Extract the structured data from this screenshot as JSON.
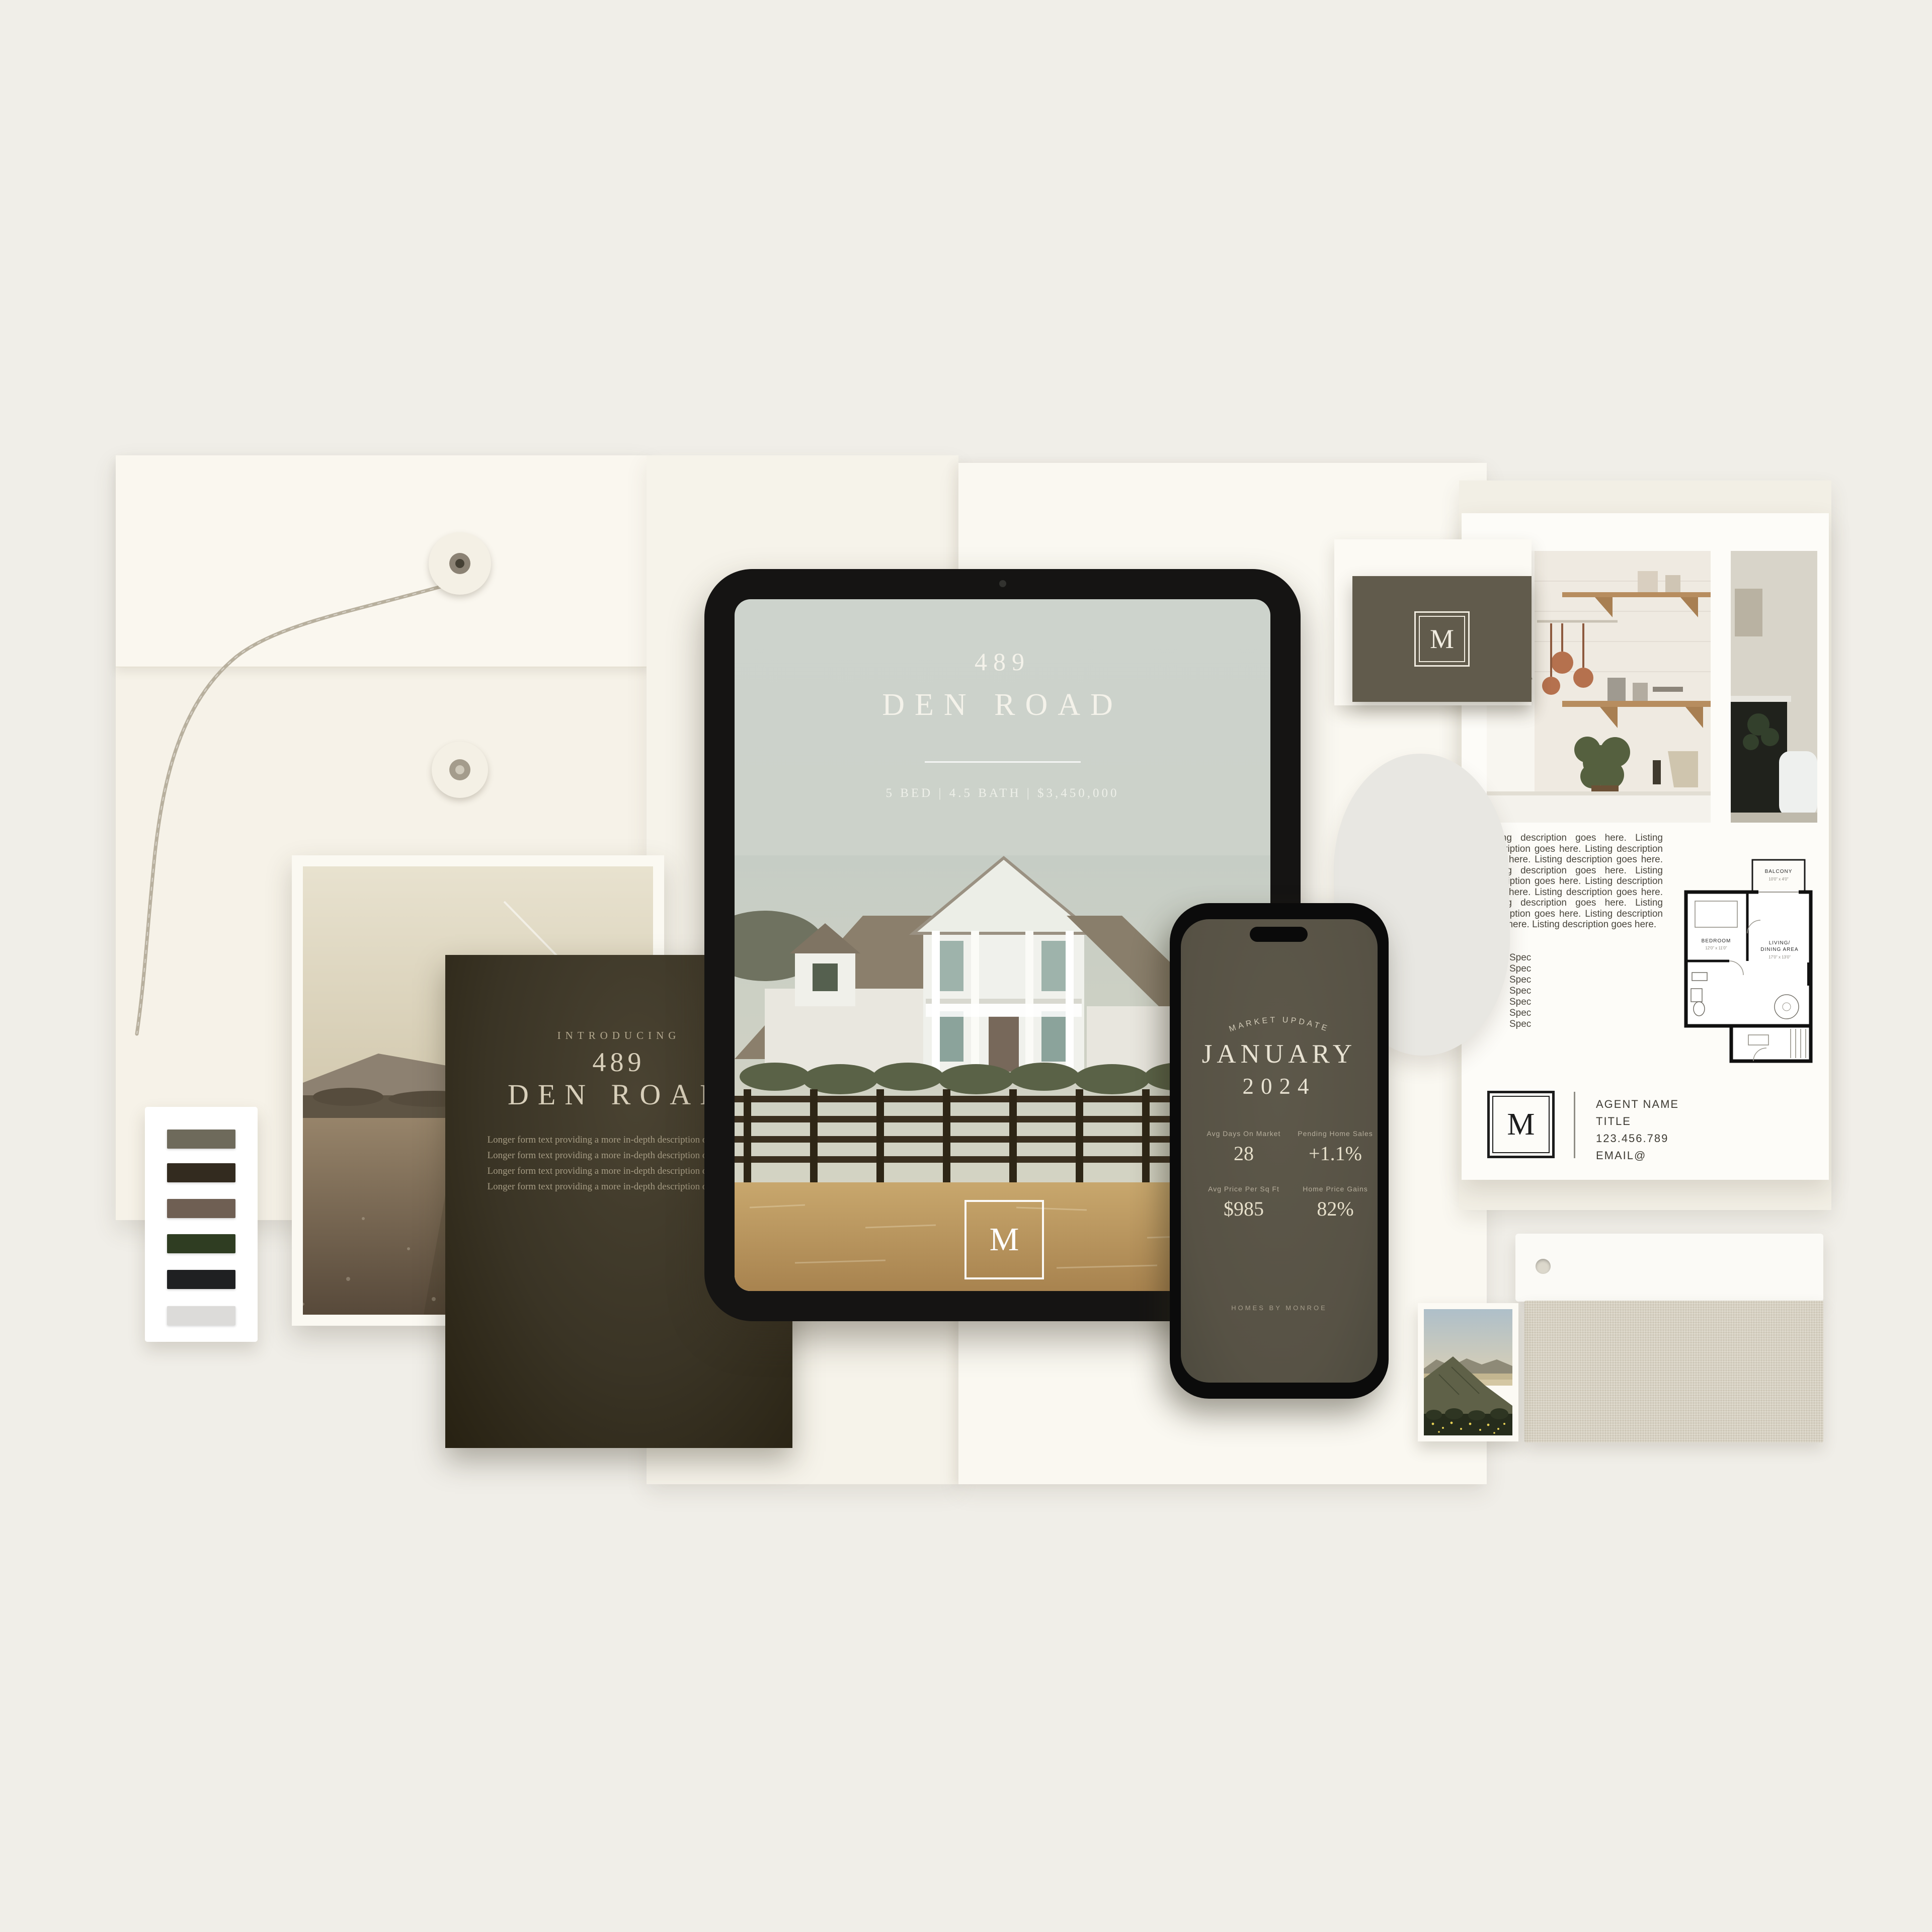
{
  "palette": {
    "colors": [
      "#6e6a5b",
      "#332b1f",
      "#6f5f53",
      "#2f3d22",
      "#1f2022",
      "#dcdbd9"
    ]
  },
  "tablet": {
    "address_number": "489",
    "address_street": "DEN ROAD",
    "listing_specs": "5 BED | 4.5 BATH | $3,450,000",
    "monogram": "M"
  },
  "phone": {
    "eyebrow": "MARKET UPDATE",
    "month": "JANUARY",
    "year": "2024",
    "stats": [
      {
        "label": "Avg Days On Market",
        "value": "28"
      },
      {
        "label": "Pending Home Sales",
        "value": "+1.1%"
      },
      {
        "label": "Avg Price Per Sq Ft",
        "value": "$985"
      },
      {
        "label": "Home Price Gains",
        "value": "82%"
      }
    ],
    "footer": "HOMES BY MONROE"
  },
  "brochure": {
    "eyebrow": "INTRODUCING",
    "address_number": "489",
    "address_street": "DEN ROAD",
    "body": "Longer form text providing a more in-depth description of the home. Longer form text providing a more in-depth description of the home. Longer form text providing a more in-depth description of the home. Longer form text providing a more in-depth description of the home."
  },
  "business_card": {
    "monogram": "M"
  },
  "flyer": {
    "description": "Listing description goes here. Listing description goes here. Listing description goes here. Listing description goes here. Listing description goes here. Listing description goes here. Listing description goes here. Listing description goes here. Listing description goes here. Listing description goes here. Listing description goes here. Listing description goes here.",
    "specs": [
      "Spec",
      "Spec",
      "Spec",
      "Spec",
      "Spec",
      "Spec",
      "Spec"
    ],
    "floorplan": {
      "balcony": "BALCONY",
      "balcony_dims": "10'0\" x 4'0\"",
      "bedroom": "BEDROOM",
      "bedroom_dims": "12'0\" x 11'0\"",
      "living_line1": "LIVING/",
      "living_line2": "DINING AREA",
      "living_dims": "17'0\" x 13'0\""
    },
    "agent": {
      "monogram": "M",
      "name": "AGENT NAME",
      "title": "TITLE",
      "phone": "123.456.789",
      "email": "EMAIL@"
    }
  }
}
